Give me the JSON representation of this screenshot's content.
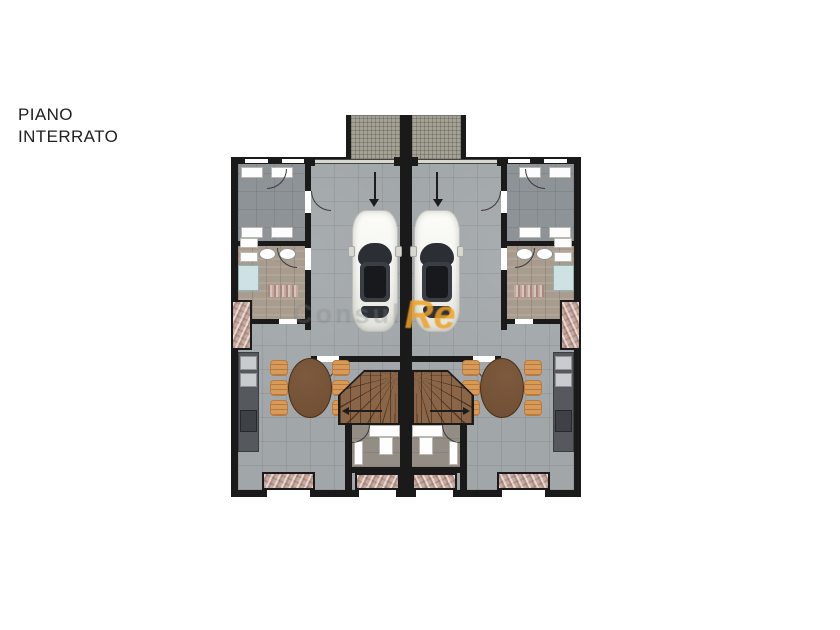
{
  "title": {
    "line1": "PIANO",
    "line2": "INTERRATO"
  },
  "watermark": {
    "prefix": "Consul",
    "accent": "Re"
  },
  "plan": {
    "kind": "floor-plan",
    "floor": "basement (piano interrato)",
    "layout": "two mirrored semi-detached units around a central party wall",
    "unit_elements": [
      "entry ramp with grid paving",
      "garage with parked car seen from above",
      "down direction arrow at garage door",
      "cellar room with four white cabinets",
      "laundry room with two round basins, two radiators, shower tray and doormat",
      "kitchen counter with appliances along outer wall",
      "oval dining table with six chairs",
      "winder staircase with direction arrow",
      "entry vestibule with white door leaves",
      "light wells with stone texture on outer and bottom walls",
      "windows as white gaps in black walls",
      "quarter-circle door swing arcs"
    ]
  },
  "colors": {
    "wall": "#1a1a1a",
    "floor": "#a1a6a9",
    "floor-dark": "#8d9397",
    "wood": "#a89c8e",
    "vestibule": "#938d86",
    "stair": "#8a6547",
    "table": "#6f4e34",
    "chair": "#d89a58",
    "chair-edge": "#b97c3e",
    "counter": "#55595d",
    "appliance": "#c8ccce",
    "appliance-dark": "#3e4246",
    "shower": "#cfe2e3",
    "ramp": "#a4a296",
    "well": "#c7aba1",
    "car": "#f4f4f1",
    "glass": "#2b2f33",
    "accent": "#efa227",
    "wm-gray": "#7e868b"
  }
}
